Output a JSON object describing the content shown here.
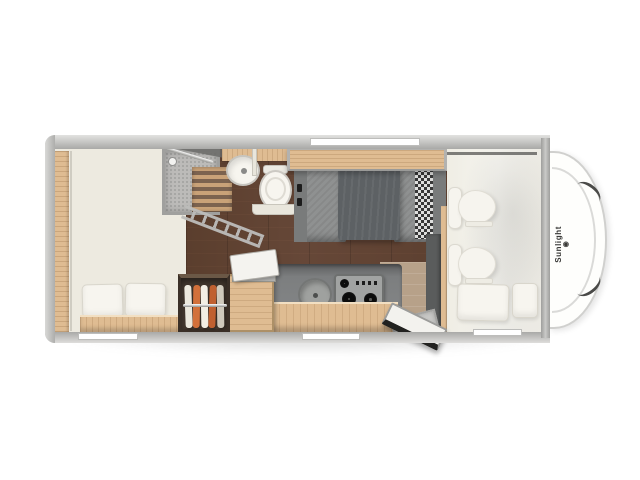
{
  "meta": {
    "title": "Sunlight motorhome floor plan — top view"
  },
  "brand": {
    "logo_text": "Sunlight",
    "logo_symbol": "◉"
  },
  "colors": {
    "background": "#ffffff",
    "wall": "#b5b5b3",
    "wall_light": "#dcdcda",
    "interior_cream": "#edeae0",
    "overcab_cream": "#f2f0e9",
    "wood": "#dfbc92",
    "wood_dark": "#8a6f57",
    "floor_dark": "#6e5b4f",
    "floor_entry": "#b7a189",
    "counter": "#7d7f7e",
    "table": "#5d6164",
    "bench": "#8f9191",
    "checker_dark": "#2e2e2e",
    "wardrobe": "#4a3d33",
    "clothes_orange": "#d2703a",
    "fixture_white": "#f7f5ef",
    "shower": "#bcbbb9",
    "seat_white": "#f6f4ee",
    "chrome": "#bdbdbb",
    "door_seal": "#222220"
  },
  "features": [
    "rear bed with two pillows",
    "side wardrobe with hanging clothes",
    "shower cabin with duckboard",
    "washbasin",
    "toilet",
    "dinette with table and flower plate",
    "overhead locker",
    "kitchen counter with sink and gas hob",
    "kitchen cabinet with open lid",
    "open entrance door with step",
    "two cab seats",
    "overcab bed with pillows",
    "cab front with Sunlight logo"
  ]
}
